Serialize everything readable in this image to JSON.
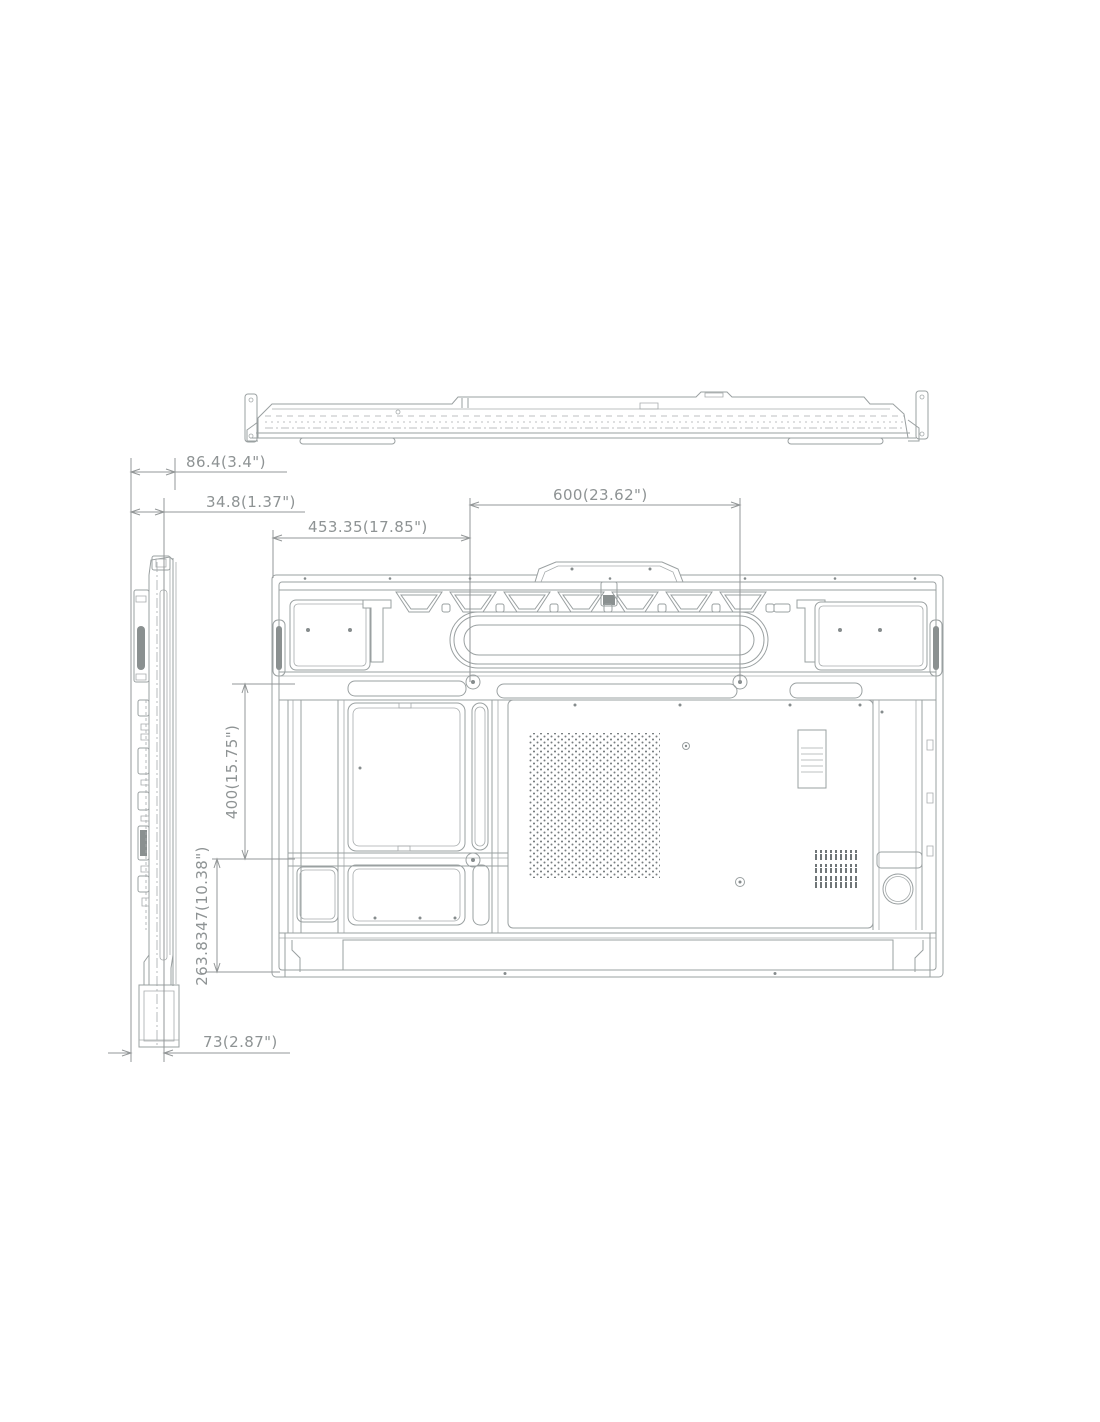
{
  "page": {
    "background": "#ffffff"
  },
  "colors": {
    "drawing_line": "#9aa0a1",
    "dimension_line": "#939798",
    "dimension_text": "#8e9394"
  },
  "views": {
    "top": "top-profile-view",
    "side": "left-side-profile-view",
    "rear": "rear-panel-view"
  },
  "dimensions": {
    "depth_total": {
      "label": "86.4(3.4\")"
    },
    "depth_back": {
      "label": "34.8(1.37\")"
    },
    "vesa_left_offset": {
      "label": "453.35(17.85\")"
    },
    "vesa_width": {
      "label": "600(23.62\")"
    },
    "vesa_height": {
      "label": "400(15.75\")"
    },
    "bottom_offset": {
      "label": "263.8347(10.38\")"
    },
    "depth_bottom": {
      "label": "73(2.87\")"
    }
  }
}
